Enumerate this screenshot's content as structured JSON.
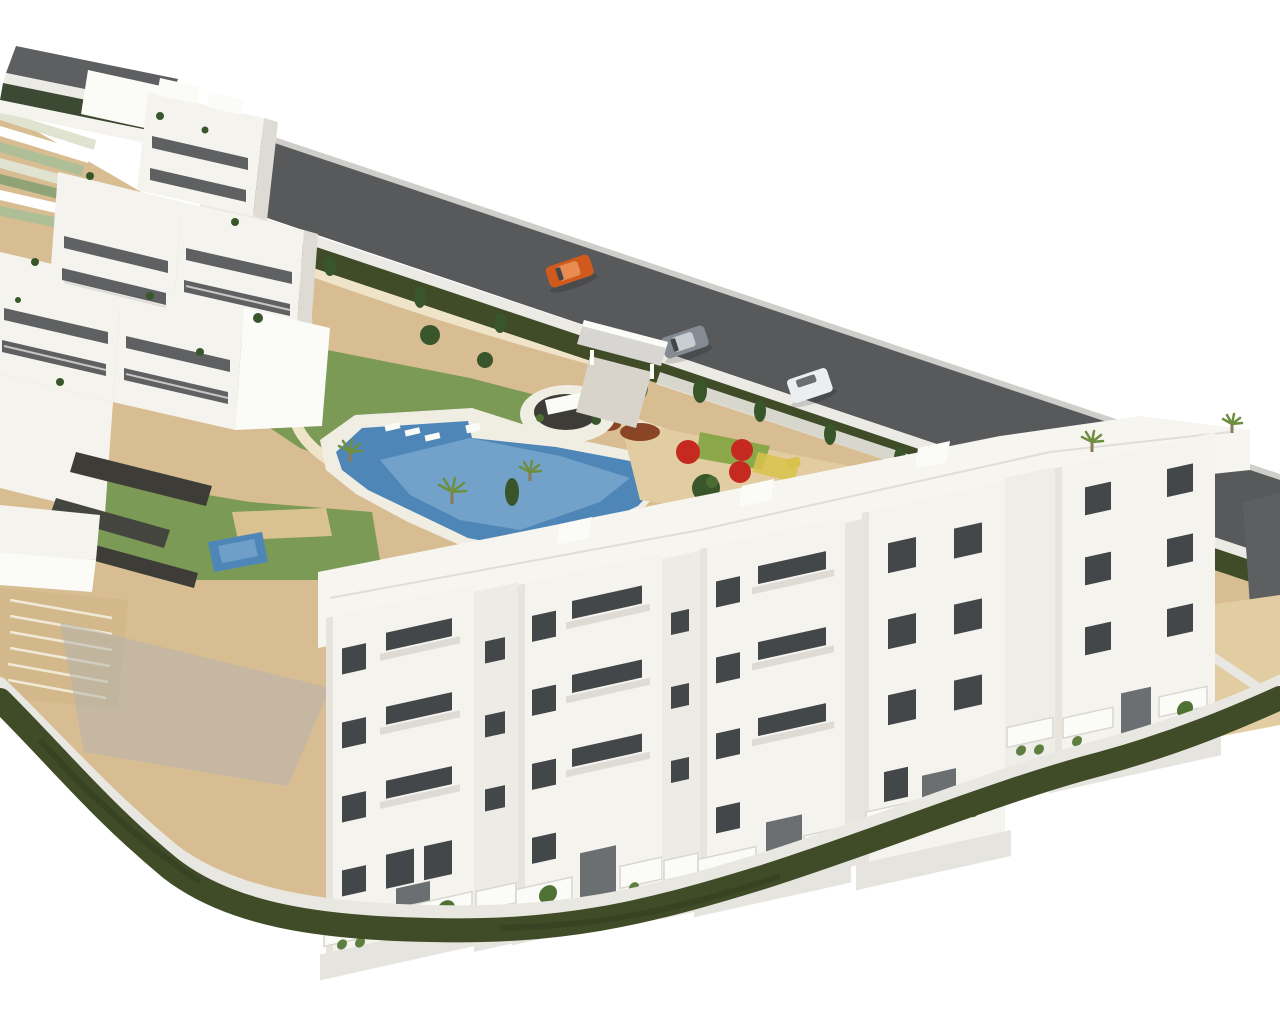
{
  "meta": {
    "title": "Aerial 3D architectural render of a white apartment development",
    "image_type": "architectural-render-aerial",
    "canvas": {
      "width": 1280,
      "height": 1024
    },
    "background": "#ffffff"
  },
  "palette": {
    "road": "#58595b",
    "road_edge": "#cfceca",
    "roof_dark": "#5e5f61",
    "fascia": "#eceae4",
    "glass_band": "#3c4a33",
    "field_light": "#dfe3cf",
    "field_green": "#aebf97",
    "field_dark": "#8fa377",
    "sand": "#d9bd92",
    "sand_light": "#e2cda3",
    "path_cream": "#efe4c8",
    "paving": "#e9e7e1",
    "shadow": "#b4b2ad",
    "lawn": "#7b9a55",
    "lawn_dark": "#5e7f41",
    "hedge": "#3f4c27",
    "tree": "#4f7134",
    "tree_dark": "#39552a",
    "palm": "#6d8f3f",
    "pool": "#4f86b8",
    "pool_light": "#85b0d3",
    "pool_deck": "#f0ede3",
    "white_wall": "#f4f3ee",
    "white_bright": "#fbfbf8",
    "wall_shade": "#dddbd3",
    "wall_deep": "#c9c7c0",
    "window": "#44474a",
    "window_light": "#6b6f72",
    "red": "#c52920",
    "play_green": "#7ba23c",
    "play_yellow": "#d9c24b",
    "shrub_red": "#8a4526",
    "gabion": "#3d3c37",
    "pergola": "#d9c28f",
    "parking": "#d3b88b",
    "stripe": "#f2ead7",
    "apron": "#e6e4de",
    "recessed": "#ecebe5",
    "canopy": "#d7d6d2",
    "driveway": "#d8d4cb",
    "rail": "#dad8d2",
    "car_orange": "#d05a1e",
    "car_silver": "#848b92",
    "car_white": "#eceff1"
  },
  "scene": {
    "view": "isometric aerial view of a residential development isolated on a white background",
    "landmarks": [
      {
        "name": "perimeter-road",
        "desc": "dark asphalt road running diagonally along the north-east boundary"
      },
      {
        "name": "street-building-roof",
        "desc": "dark grey flat roof of a neighbouring building, top-left corner"
      },
      {
        "name": "crop-terraces",
        "desc": "striped green field terraces at the top-left edge"
      },
      {
        "name": "entrance-gate",
        "desc": "flat white canopy over the vehicle entrance from the road"
      },
      {
        "name": "roundabout",
        "desc": "oval planted roundabout with a white sign monument inside the entrance"
      },
      {
        "name": "communal-pool",
        "desc": "free-form blue swimming pool with sun deck, loungers and palm trees"
      },
      {
        "name": "private-pool",
        "desc": "small rectangular pool with straw pergola in the south-west garden"
      },
      {
        "name": "playground",
        "desc": "sandy playground with three red shade umbrellas, coloured play equipment and olive trees"
      },
      {
        "name": "garden",
        "desc": "sandy landscaped garden with lawns, cream footpaths, shrubs and trees"
      },
      {
        "name": "perimeter-hedge",
        "desc": "dark green hedge along the road and the curved southern boundary"
      },
      {
        "name": "parking-bays",
        "desc": "tan parking area with white bay stripes, west corner"
      },
      {
        "name": "left-apartment-cluster",
        "desc": "stepped cluster of white apartment blocks with terraces and dark window bands, west side"
      },
      {
        "name": "front-apartment-row",
        "desc": "row of five four-storey white apartment blocks with dark windows and ground-floor terraces, south side"
      },
      {
        "name": "roof-terraces",
        "desc": "white roof terraces with railings and stair bulkheads behind the front row"
      },
      {
        "name": "east-courtyard",
        "desc": "tan courtyard with white path at the east corner"
      },
      {
        "name": "rock-gabions",
        "desc": "dark rock gabion strips on the landscaped slope, lower left"
      }
    ],
    "buildings": {
      "front_row_blocks": 5,
      "storeys_per_block": 4,
      "facade_color": "#f4f3ee",
      "window_color": "#44474a"
    },
    "vehicles": [
      {
        "name": "orange-car",
        "color": "#d05a1e",
        "location": "driving on the road, upper centre"
      },
      {
        "name": "silver-car",
        "color": "#848b92",
        "location": "parked on the road near the entrance gate"
      },
      {
        "name": "white-van",
        "color": "#eceff1",
        "location": "on the road right of the entrance"
      }
    ],
    "amenities_colors": {
      "pool_water": "#4f86b8",
      "umbrellas": "#c52920",
      "lawn": "#7b9a55",
      "sand_ground": "#d9bd92"
    }
  }
}
